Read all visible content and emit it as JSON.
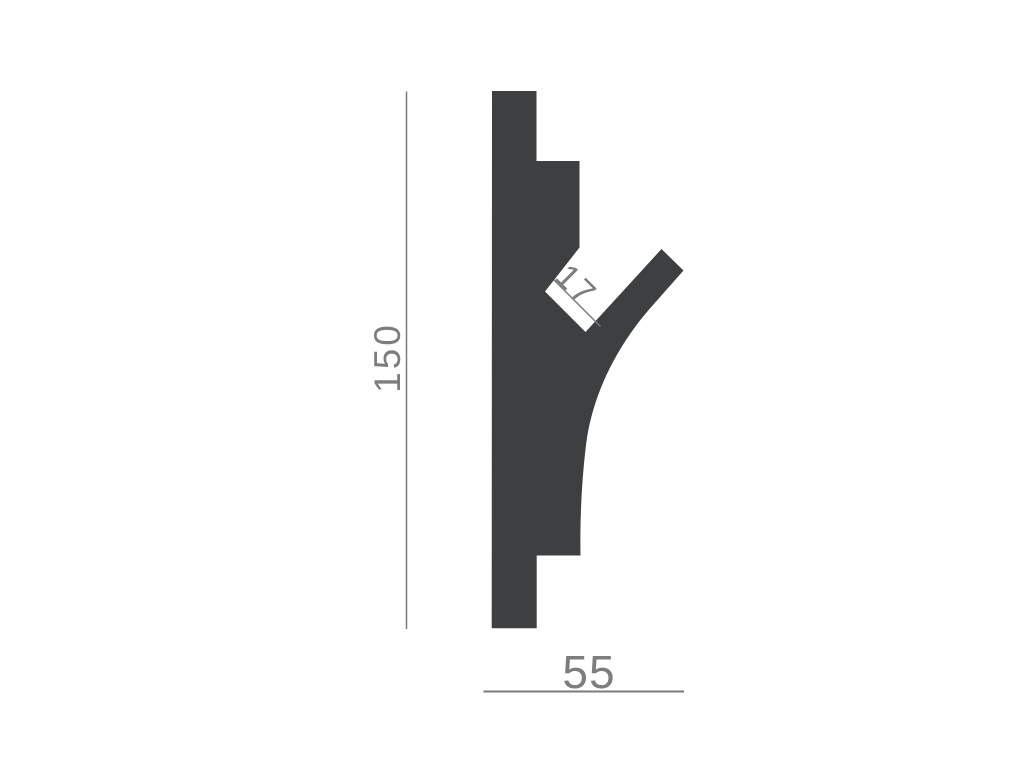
{
  "diagram": {
    "colors": {
      "profile_fill": "#3e3f41",
      "dimension_line": "#7a7b7c",
      "dimension_text": "#7c7d7f",
      "background": "#ffffff"
    },
    "profile": {
      "path_d": "M 492,91 L 536.5,91 L 536.5,161 L 579.5,161 L 579.5,247.5 L 545,291.5 L 585.5,332 L 661.5,249 L 683.5,270.5 L 653,305 C 617,345 592,395 586,445 C 581,487 580,525 580.5,555.5 L 536.7,555.5 L 536.7,628.3 L 491.7,628.3 Z"
    },
    "dimensions": {
      "height": {
        "value": "150",
        "orientation": "vertical"
      },
      "width": {
        "value": "55",
        "orientation": "horizontal"
      },
      "slot": {
        "value": "17",
        "orientation": "diagonal-45deg"
      }
    }
  }
}
